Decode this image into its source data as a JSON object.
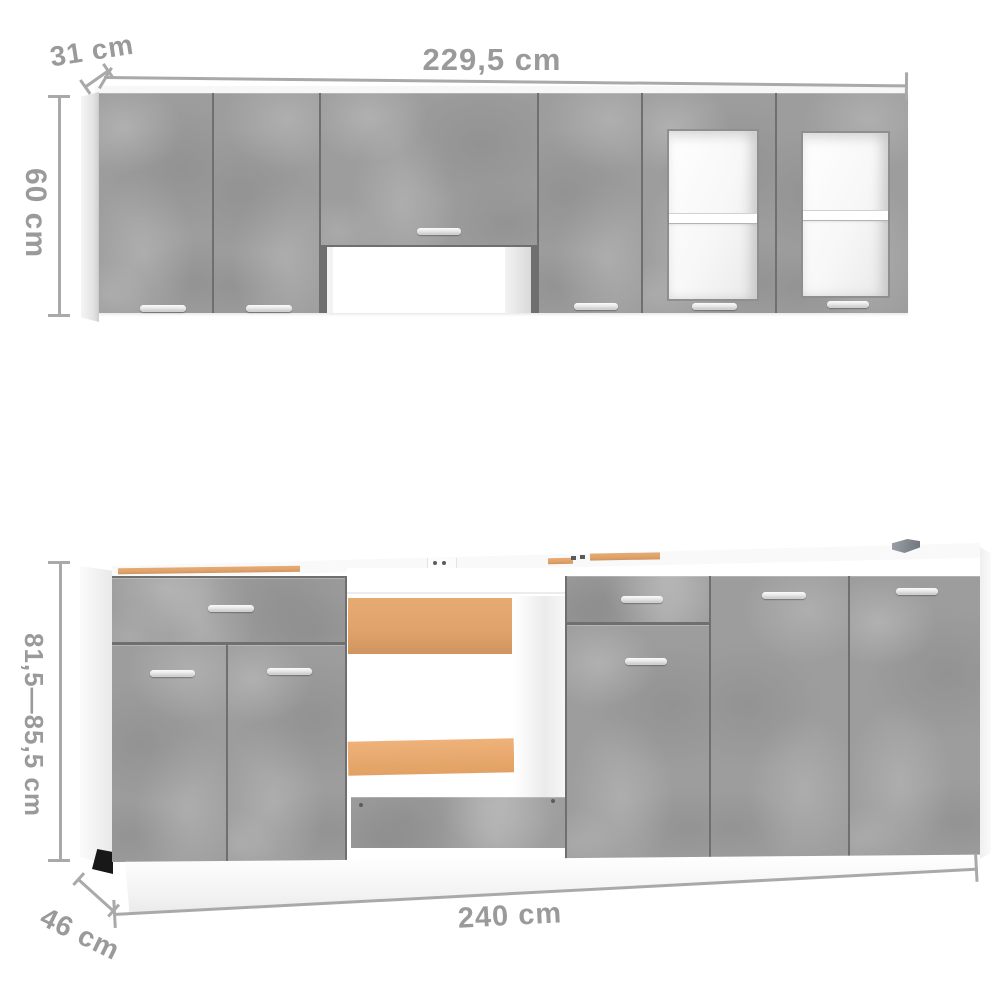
{
  "image_type": "product-dimension-diagram",
  "product": "kitchen-cabinet-set-concrete-grey",
  "annotations": {
    "upper_depth": "31 cm",
    "upper_width": "229,5 cm",
    "upper_height": "60 cm",
    "lower_height": "81,5—85,5 cm",
    "lower_width": "240 cm",
    "lower_depth": "46 cm"
  },
  "palette": {
    "concrete_grey": "#9d9d9d",
    "panel_white": "#f5f5f5",
    "seam_grey": "#6f6f6f",
    "chipboard_tan": "#dfa26a",
    "dimension_line_grey": "#a9a9a9",
    "dimension_text_grey": "#9a9a9a",
    "handle_silver": "#e8e8e8",
    "background": "#ffffff"
  }
}
